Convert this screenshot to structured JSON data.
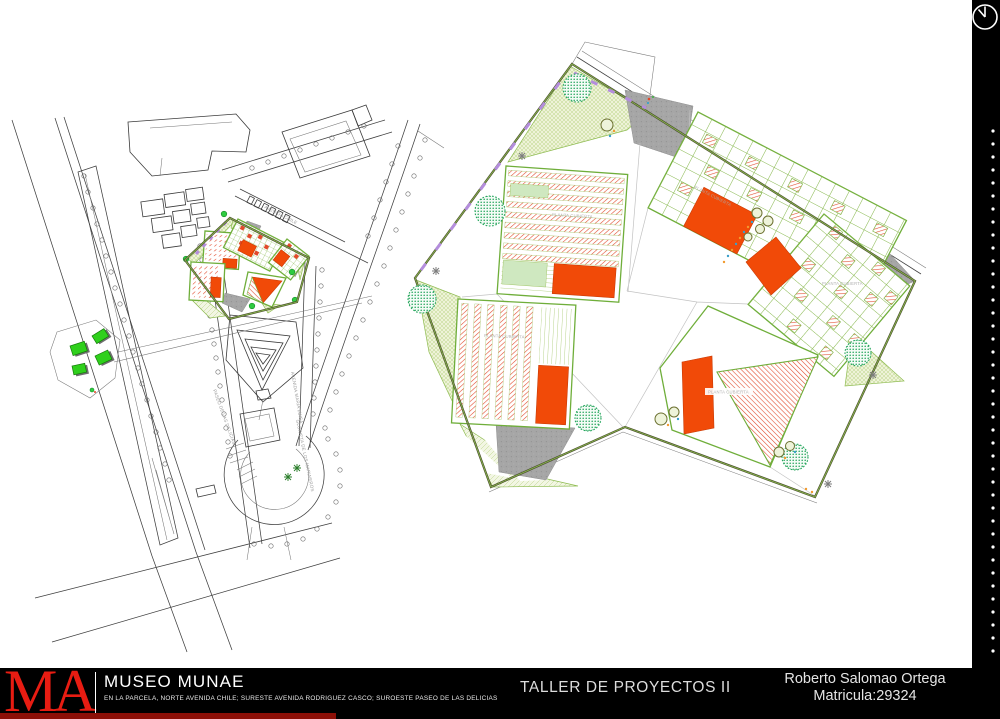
{
  "title_block": {
    "logo_text": "MA",
    "project_name": "MUSEO MUNAE",
    "project_description": "EN LA PARCELA, NORTE AVENIDA CHILE; SURESTE AVENIDA RODRIGUEZ CASCO; SUROESTE PASEO DE LAS DELICIAS",
    "course_title": "TALLER DE PROYECTOS II",
    "author_name": "Roberto Salomao Ortega",
    "author_id": "Matricula:29324"
  },
  "site_map": {
    "street_labels": {
      "avenida_chile": "AVENIDA CHILE",
      "paseo_de_las_delicias": "PASEO DE LAS DELICIAS",
      "avenida_maria_luisa": "AVENIDA MARIA LUISA",
      "glorieta_de_los_marineros": "GLORIETA DE LOS MARINEROS"
    }
  },
  "master_plan": {
    "roof_plan_label": "PLANTA CUBIERTA"
  },
  "decor": {
    "binding_dots_count": 41
  },
  "colors": {
    "accent_red": "#e81c12",
    "building_orange": "#f14a08",
    "hatch_red": "#e2492b",
    "grid_green": "#86b74c",
    "lawn_fill": "#eef3d8",
    "lawn_line": "#bcd48a",
    "plaza_gray": "#a6a6a6",
    "tree_green": "#23a55b",
    "path_purple": "#b48ddd",
    "footer_black": "#000000",
    "deep_red_strip": "#8c0f07"
  }
}
